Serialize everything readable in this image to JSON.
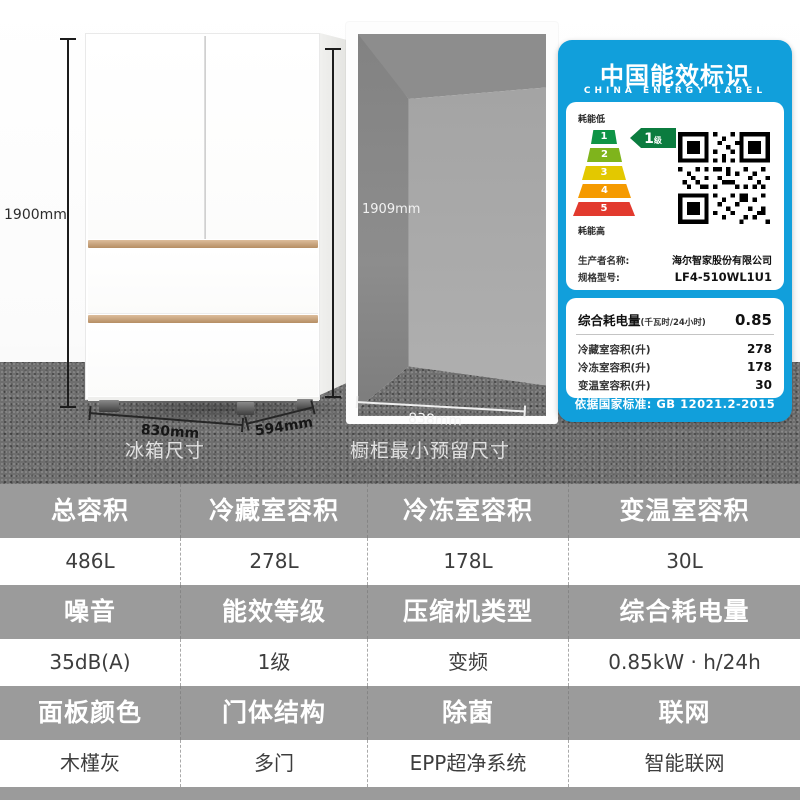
{
  "scene": {
    "fridge": {
      "height_label": "1900mm",
      "width_label": "830mm",
      "depth_label": "594mm",
      "caption": "冰箱尺寸"
    },
    "cabinet": {
      "height_label": "1909mm",
      "width_label": "838mm",
      "caption": "橱柜最小预留尺寸"
    },
    "energy_label": {
      "accent_color": "#119fdb",
      "title": "中国能效标识",
      "subtitle": "CHINA ENERGY LABEL",
      "low_label": "耗能低",
      "high_label": "耗能高",
      "grade_value": "1",
      "grade_unit": "级",
      "grade_bg": "#0b7c3f",
      "tiers": [
        "1",
        "2",
        "3",
        "4",
        "5"
      ],
      "tier_colors": [
        "#0e9446",
        "#7fb41c",
        "#e3c800",
        "#f59a00",
        "#e23a2e"
      ],
      "producer_label": "生产者名称:",
      "producer_value": "海尔智家股份有限公司",
      "model_label": "规格型号:",
      "model_value": "LF4-510WL1U1",
      "consumption_label": "综合耗电量",
      "consumption_unit": "(千瓦时/24小时)",
      "consumption_value": "0.85",
      "rows": [
        {
          "label": "冷藏室容积(升)",
          "value": "278"
        },
        {
          "label": "冷冻室容积(升)",
          "value": "178"
        },
        {
          "label": "变温室容积(升)",
          "value": "30"
        }
      ],
      "footer": "依据国家标准: GB 12021.2-2015"
    }
  },
  "spec_table": {
    "header_bg": "#9b9b9b",
    "groups": [
      {
        "cells": [
          {
            "label": "总容积",
            "value": "486L"
          },
          {
            "label": "冷藏室容积",
            "value": "278L"
          },
          {
            "label": "冷冻室容积",
            "value": "178L"
          },
          {
            "label": "变温室容积",
            "value": "30L"
          }
        ]
      },
      {
        "cells": [
          {
            "label": "噪音",
            "value": "35dB(A)"
          },
          {
            "label": "能效等级",
            "value": "1级"
          },
          {
            "label": "压缩机类型",
            "value": "变频"
          },
          {
            "label": "综合耗电量",
            "value": "0.85kW · h/24h"
          }
        ]
      },
      {
        "cells": [
          {
            "label": "面板颜色",
            "value": "木槿灰"
          },
          {
            "label": "门体结构",
            "value": "多门"
          },
          {
            "label": "除菌",
            "value": "EPP超净系统"
          },
          {
            "label": "联网",
            "value": "智能联网"
          }
        ]
      }
    ]
  }
}
